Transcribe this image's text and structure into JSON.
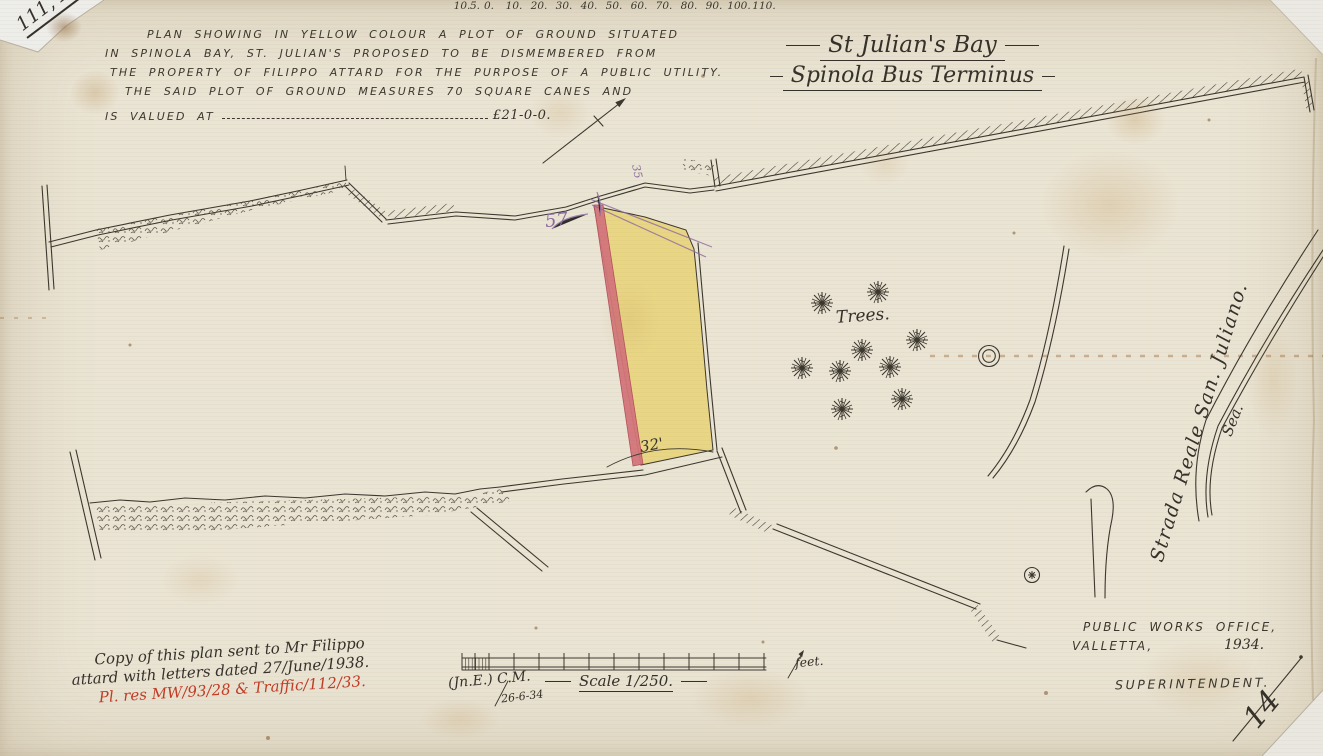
{
  "corner": {
    "ref": "111, E."
  },
  "description": {
    "lines": [
      "PLAN SHOWING IN YELLOW COLOUR A PLOT OF GROUND SITUATED",
      "IN SPINOLA BAY, ST. JULIAN'S PROPOSED TO BE DISMEMBERED FROM",
      "THE PROPERTY OF FILIPPO ATTARD FOR THE PURPOSE OF A PUBLIC UTILITY.",
      "THE SAID PLOT OF GROUND MEASURES 70 SQUARE CANES AND",
      "IS VALUED AT"
    ],
    "value": "£21-0-0."
  },
  "title": {
    "line1": "St Julian's Bay",
    "line2": "Spinola Bus Terminus"
  },
  "map_labels": {
    "trees": "Trees.",
    "road": "Strada Reale San. Juliano.",
    "sea": "Sea.",
    "dim_57": "57",
    "dim_32": "32'",
    "dim_35": "35"
  },
  "office": {
    "line1": "PUBLIC WORKS OFFICE,",
    "line2": "VALLETTA,",
    "year": "1934.",
    "role": "SUPERINTENDENT."
  },
  "notes": {
    "line1": "Copy of this plan sent to Mr Filippo",
    "line2": "attard with letters dated 27/June/1938.",
    "refs": "Pl. res MW/93/28 & Traffic/112/33."
  },
  "scalebar": {
    "ticks": [
      "10.",
      "5.",
      "0.",
      "10.",
      "20.",
      "30.",
      "40.",
      "50.",
      "60.",
      "70.",
      "80.",
      "90.",
      "100.",
      "110."
    ],
    "unit": "feet.",
    "scale_label": "Scale 1/250.",
    "initials": "(Jn.E.) C.M.",
    "date": "26-6-34"
  },
  "sheet": {
    "number": "14"
  },
  "map": {
    "tree_positions": [
      [
        822,
        303
      ],
      [
        878,
        292
      ],
      [
        917,
        340
      ],
      [
        862,
        350
      ],
      [
        802,
        368
      ],
      [
        840,
        371
      ],
      [
        890,
        367
      ],
      [
        902,
        399
      ],
      [
        842,
        409
      ]
    ]
  },
  "colors": {
    "paper": "#eae4d4",
    "ink": "#3b372e",
    "plot_yellow": "#e8d57e",
    "plot_red": "#d4757b",
    "annotation_purple": "#8d6aa0",
    "note_red": "#c23a24"
  }
}
